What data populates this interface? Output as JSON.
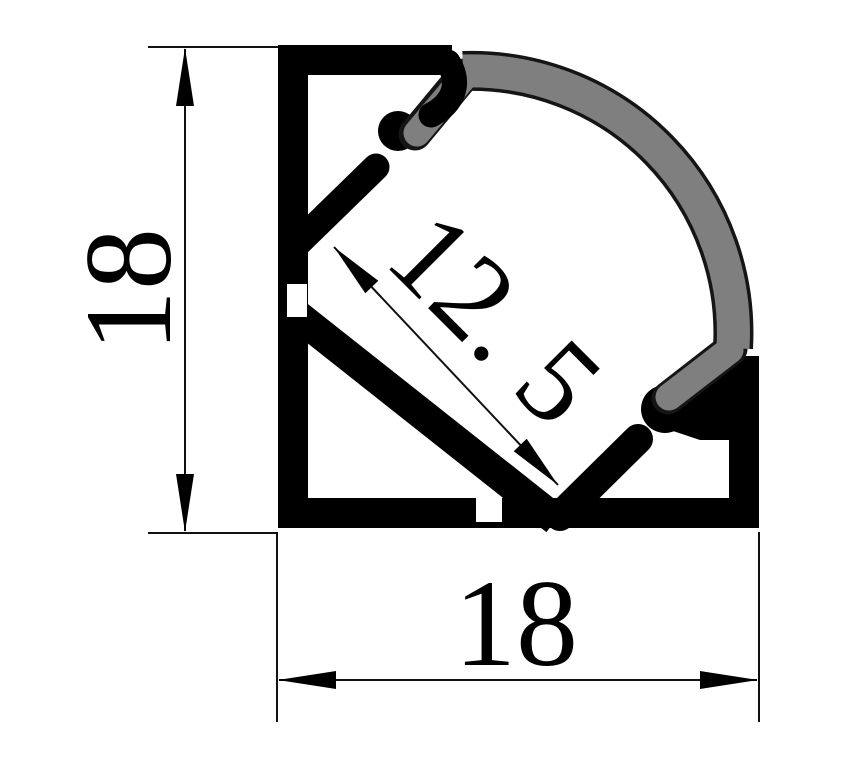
{
  "drawing": {
    "background": "#ffffff",
    "profile": {
      "part": "aluminum-corner-profile-cross-section",
      "body_color": "#000000",
      "diffuser_color": "#7f7f7f",
      "diffuser_outline_color": "#151515"
    },
    "dimension_line_color": "#111111",
    "dimensions": {
      "height": {
        "label": "18",
        "orientation": "vertical"
      },
      "width": {
        "label": "18",
        "orientation": "horizontal"
      },
      "channel": {
        "label": "12. 5",
        "orientation": "diagonal-45deg"
      }
    }
  }
}
